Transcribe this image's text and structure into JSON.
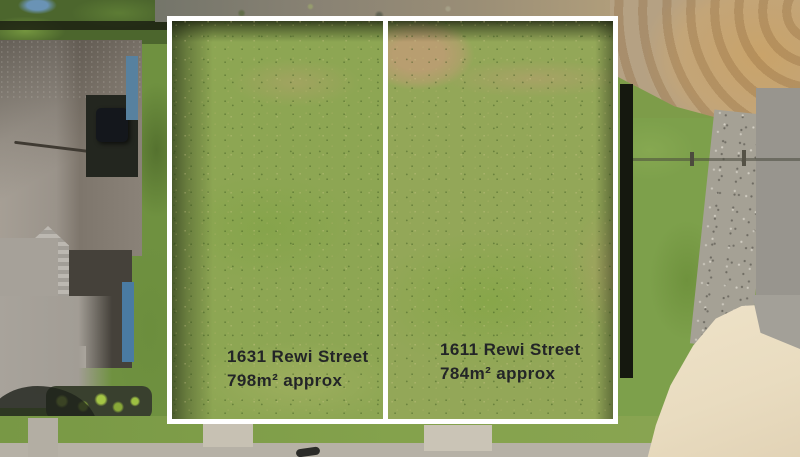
{
  "scene": {
    "type": "aerial-drone-photo",
    "overlay_colors": {
      "boundary_line": "#ffffff",
      "label_text": "#232527"
    },
    "palette": {
      "lot_grass": "#8da653",
      "lawn": "#6f9140",
      "roof": "#8a8278",
      "gravel_road": "#c3a578",
      "concrete_apron": "#e9dcc0",
      "sidewalk": "#b6b1a6"
    }
  },
  "lots": [
    {
      "address": "1631 Rewi Street",
      "area": "798m² approx"
    },
    {
      "address": "1611 Rewi Street",
      "area": "784m² approx"
    }
  ]
}
